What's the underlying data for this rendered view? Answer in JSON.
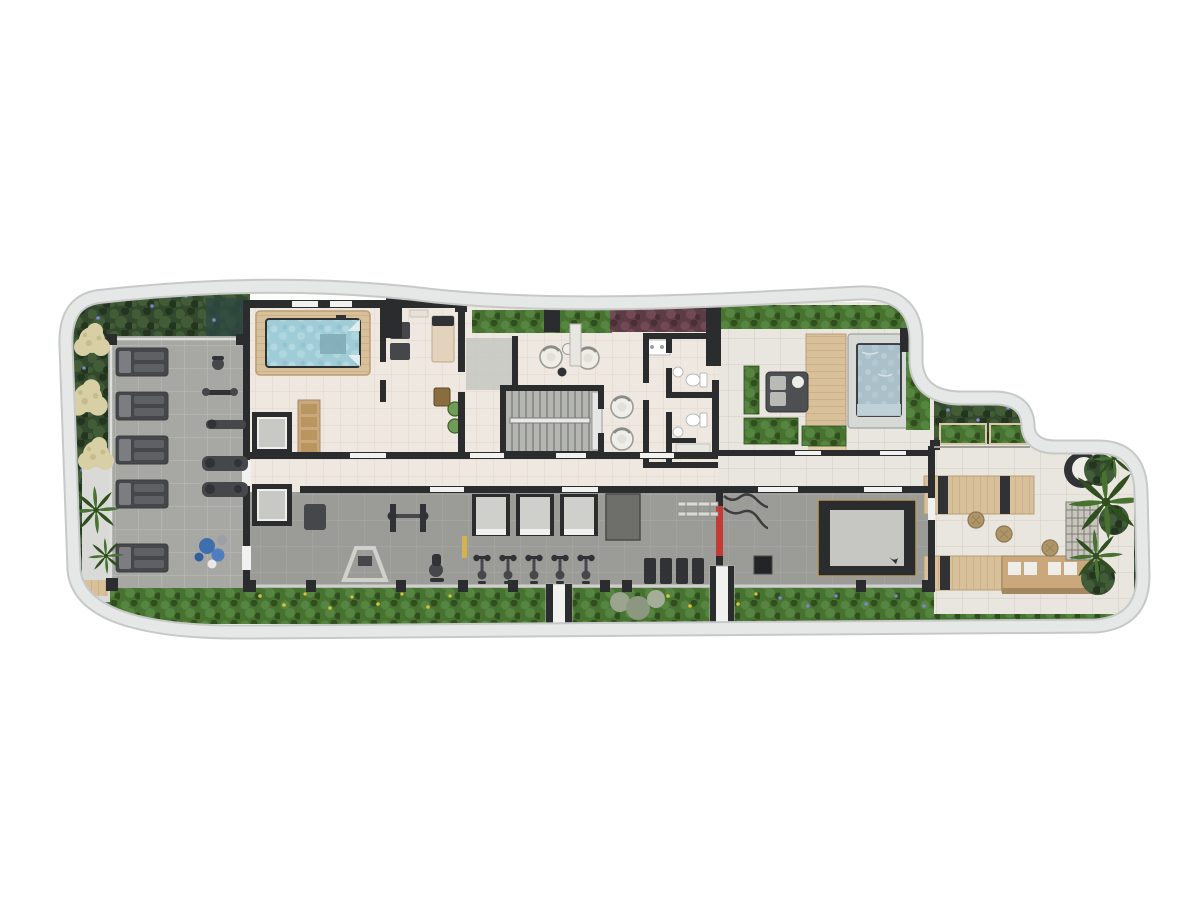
{
  "labels": {
    "plan": "amenities-floor-plan",
    "garden": "perimeter-garden",
    "indoor_pool_room": "indoor-pool-room",
    "pool": "indoor-pool",
    "treatment_room": "treatment-room",
    "elevator_core": "elevator-core",
    "stairs": "staircase",
    "lobby": "lounge-lobby",
    "restrooms": "restrooms",
    "outdoor_deck": "outdoor-lounge-deck",
    "spa": "spa-plunge-pool",
    "east_terrace": "east-terrace",
    "gym": "fitness-area",
    "sun_terrace": "sunbed-terrace",
    "south_garden": "south-garden",
    "side_walkway": "side-walkway"
  },
  "counts": {
    "sunbeds": 5,
    "spin_bikes": 5,
    "elevators": 2,
    "workout_platforms": 3,
    "lobby_armchairs": 4,
    "toilets": 2,
    "poufs": 3,
    "cream_bushes": 3
  },
  "colors": {
    "bg": "#ffffff",
    "band": "#e6e7e7",
    "band_edge": "#c7c9c9",
    "wall": "#2b2c2e",
    "window": "#f1f1ef",
    "tile_cream": "#efe8e1",
    "tile_cream_line": "#e0d6ca",
    "tile_stone": "#e9e5df",
    "tile_stone_line": "#d9d2c7",
    "terr_gray": "#a7a8a4",
    "terr_gray_line": "#bcbdb9",
    "gym_gray": "#9b9c98",
    "gym_gray_line": "#a9aaa6",
    "wood": "#d8c09a",
    "wood_line": "#c0a175",
    "wood_dark": "#caa87c",
    "water": "#9fccd6",
    "water_hi": "#c2e2e8",
    "spa_water": "#a9c0ca",
    "spa_water_hi": "#c3d3da",
    "leaf_dark": "#33492d",
    "leaf_dark2": "#415c37",
    "leaf_darker": "#24351f",
    "leaf_bright": "#477230",
    "leaf_bright2": "#558540",
    "leaf_bright_dark": "#2f4f1e",
    "leaf_maroon": "#5e3c46",
    "leaf_maroon2": "#714a56",
    "flower_blue": "#7d88c8",
    "flower_yellow": "#d9c23f",
    "bush_cream": "#d8d0a4",
    "equip": "#46474a",
    "equip_dark": "#313235",
    "cushion": "#efede7",
    "accent_red": "#c23b35",
    "accent_yellow": "#d4b34a",
    "ball_blue": "#3f6eae",
    "pouf": "#ad9568",
    "stone_rim": "#d6d9d5",
    "rail_glass": "#dededd"
  }
}
